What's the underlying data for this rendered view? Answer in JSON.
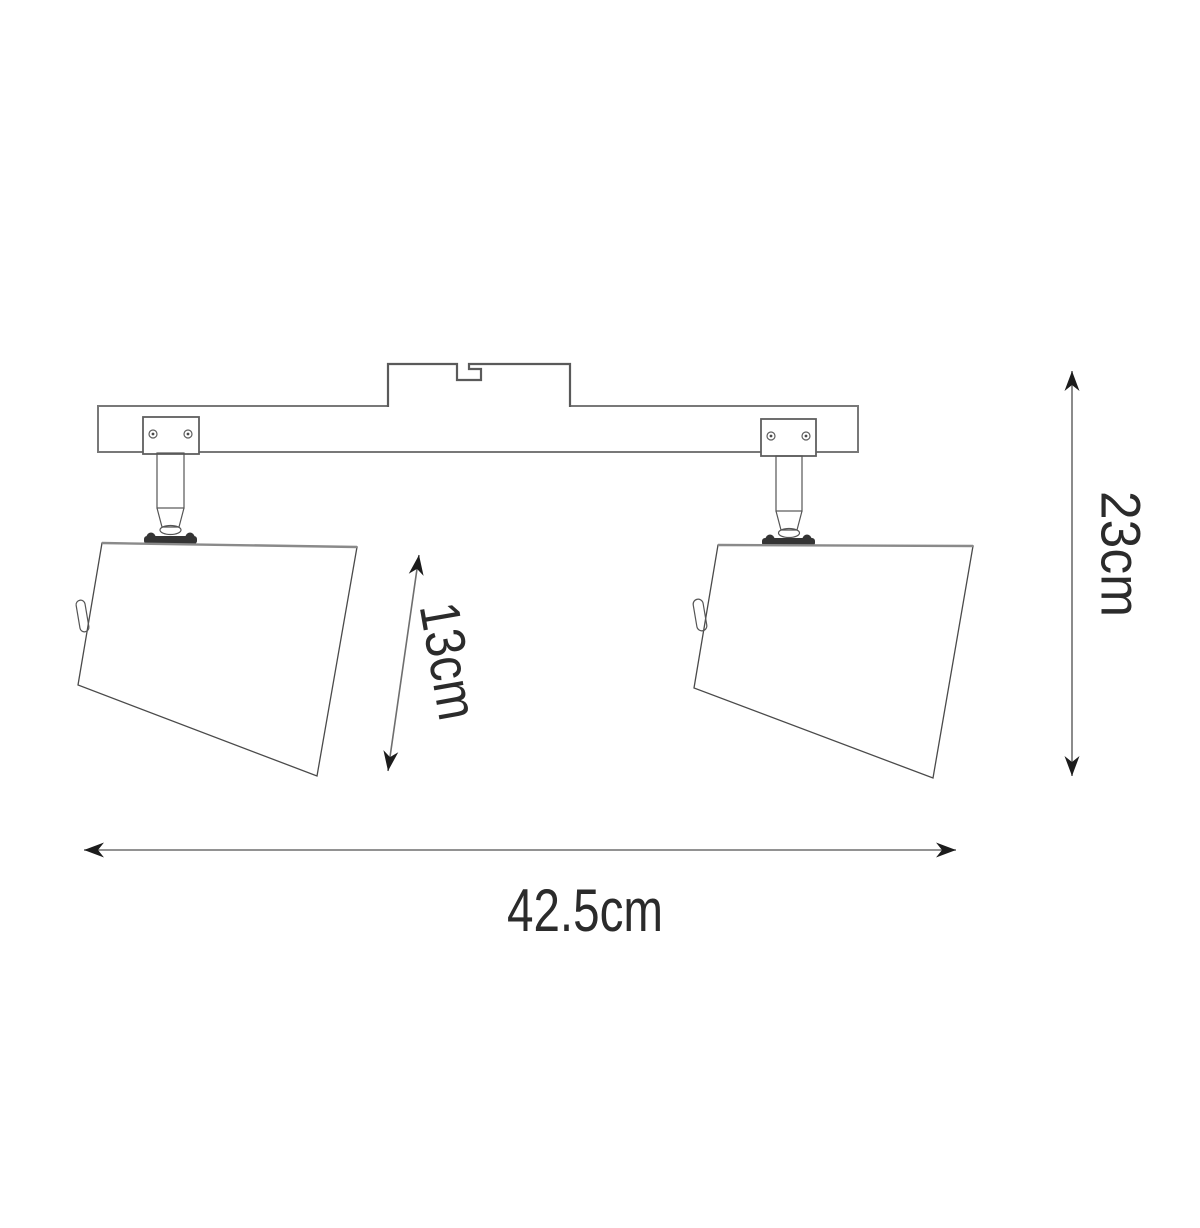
{
  "figure": {
    "subject": "two-head ceiling spotlight fixture, technical line drawing with dimensions"
  },
  "dimensions": {
    "overall_width": {
      "label": "42.5cm",
      "value": 42.5,
      "unit": "cm"
    },
    "overall_height": {
      "label": "23cm",
      "value": 23,
      "unit": "cm"
    },
    "shade_height": {
      "label": "13cm",
      "value": 13,
      "unit": "cm"
    }
  },
  "colors": {
    "background": "#ffffff",
    "outline": "#5f5f5f",
    "dimension_line": "#6e6e6e",
    "arrowhead": "#1c1c1c",
    "text": "#2b2b2b"
  }
}
